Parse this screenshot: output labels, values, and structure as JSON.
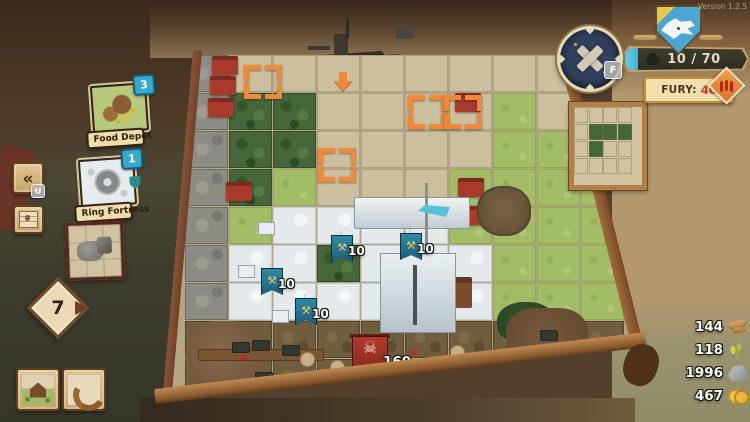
{
  "meta": {
    "version": "Version 1.2.5"
  },
  "hud": {
    "compass_hotkey": "F",
    "health_text": "10 / 70",
    "fury_label": "FURY:",
    "fury_value": "40"
  },
  "hand": {
    "undo_hotkey": "U",
    "cards": [
      {
        "label": "Food Depot",
        "count": "3"
      },
      {
        "label": "Ring Fortress",
        "count": "1"
      }
    ],
    "deck_count": "7"
  },
  "resources": [
    {
      "icon": "wood-icon",
      "value": "144"
    },
    {
      "icon": "wheat-icon",
      "value": "118"
    },
    {
      "icon": "stone-icon",
      "value": "1996"
    },
    {
      "icon": "gold-icon",
      "value": "467"
    }
  ],
  "board": {
    "tile_rows": [
      "RSSSSSSSS.",
      "RFFSSSSGS.",
      "RFFSSSSGGG",
      "RFGSSSGGGG",
      "RGWWWWGGGG",
      "RWWFWWWGGG",
      "RWWWWWWGGG",
      "CCCCCCCCCC",
      "CCCCCCCCCC"
    ],
    "unit_banners": [
      {
        "x": 163,
        "y": 176,
        "label": "10"
      },
      {
        "x": 232,
        "y": 174,
        "label": "10"
      },
      {
        "x": 93,
        "y": 209,
        "label": "10"
      },
      {
        "x": 127,
        "y": 239,
        "label": "10"
      }
    ],
    "enemy_banner": {
      "x": 184,
      "y": 279,
      "label": "160"
    },
    "target_brackets": [
      {
        "x": 76,
        "y": 10
      },
      {
        "x": 240,
        "y": 40
      },
      {
        "x": 276,
        "y": 40
      },
      {
        "x": 150,
        "y": 93
      }
    ],
    "drop_arrow": {
      "x": 166,
      "y": 17
    }
  },
  "mini_map": {
    "rows": [
      "....",
      ".FFF",
      ".F..",
      "...."
    ]
  },
  "colors": {
    "accent_cyan": "#3aa8cc",
    "bracket_orange": "#ef8a3a",
    "fury_red": "#d83a20",
    "banner_cream": "#f2dcaa",
    "health_fill": "#56c8e0",
    "enemy_red": "#b03a2c"
  }
}
